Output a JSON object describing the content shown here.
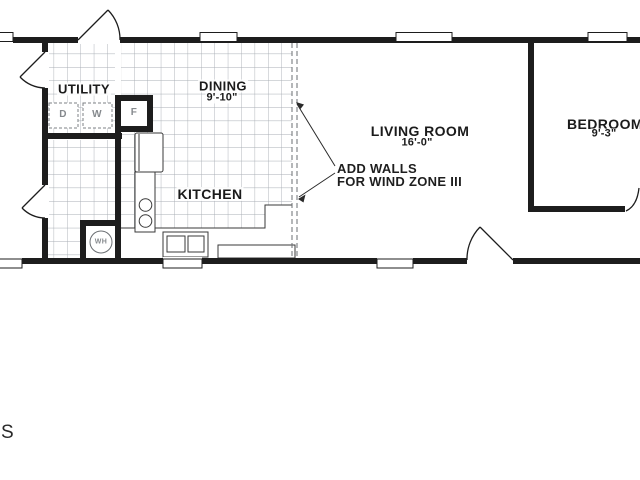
{
  "rooms": {
    "utility": {
      "label": "UTILITY"
    },
    "dining": {
      "label": "DINING",
      "dim": "9'-10\""
    },
    "kitchen": {
      "label": "KITCHEN"
    },
    "living": {
      "label": "LIVING ROOM",
      "dim": "16'-0\""
    },
    "bedroom": {
      "label": "BEDROOM",
      "dim": "9'-3\""
    }
  },
  "annotation": {
    "line1": "ADD WALLS",
    "line2": "FOR WIND ZONE III"
  },
  "fixtures": {
    "dryer": "D",
    "washer": "W",
    "furnace": "F",
    "water_heater": "WH"
  },
  "corner_text": "S",
  "colors": {
    "wall": "#1d1d1d",
    "tile_line": "#a8aeb4",
    "dashed_wall": "#6b6f73",
    "fixture_stroke": "#3a3a3a",
    "appliance_label": "#85898d"
  }
}
